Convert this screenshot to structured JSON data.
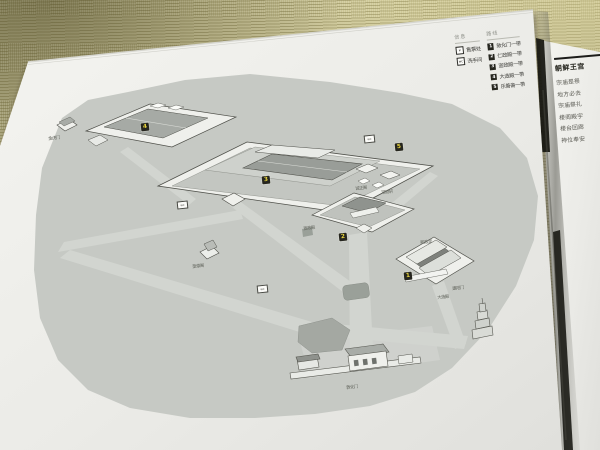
{
  "colors": {
    "page": "#f2f2ee",
    "tatami": "#b7b28a",
    "map_ground": "#c6c9c4",
    "path": "#d2d5d0",
    "building": "#eff0ec",
    "roof": "#999d98",
    "marker_bg": "#26261f",
    "marker_num": "#e8d43f",
    "legend_text": "#3a3a36",
    "rule": "#1c1c1a"
  },
  "legend": {
    "info_header": "信息",
    "route_header": "路线",
    "info_items": [
      {
        "icon": "ticket-icon",
        "glyph": "¥",
        "label": "售票处"
      },
      {
        "icon": "wc-icon",
        "glyph": "wc",
        "label": "洗手间"
      }
    ],
    "route_items": [
      {
        "num": "1",
        "label": "敦化门一带"
      },
      {
        "num": "2",
        "label": "仁政殿一带"
      },
      {
        "num": "3",
        "label": "宣政殿一带"
      },
      {
        "num": "4",
        "label": "大造殿一带"
      },
      {
        "num": "5",
        "label": "乐善斋一带"
      }
    ]
  },
  "map": {
    "markers": [
      {
        "num": "1"
      },
      {
        "num": "2"
      },
      {
        "num": "3"
      },
      {
        "num": "4"
      },
      {
        "num": "5"
      }
    ],
    "labels": [
      {
        "text": "金虎门"
      },
      {
        "text": "奎章阁"
      },
      {
        "text": "宣政殿"
      },
      {
        "text": "熙政堂"
      },
      {
        "text": "诚正阁"
      },
      {
        "text": "观物轩"
      },
      {
        "text": "大造殿"
      },
      {
        "text": "建阳门"
      },
      {
        "text": "敦化门"
      }
    ],
    "wc_label": "wc"
  },
  "right_page": {
    "heading": "朝鲜王宫",
    "lines": [
      "宗庙是祭",
      "地方必去",
      "宗庙祭礼",
      "楼阁殿宇",
      "楼台回廊",
      "神位奉安"
    ]
  }
}
